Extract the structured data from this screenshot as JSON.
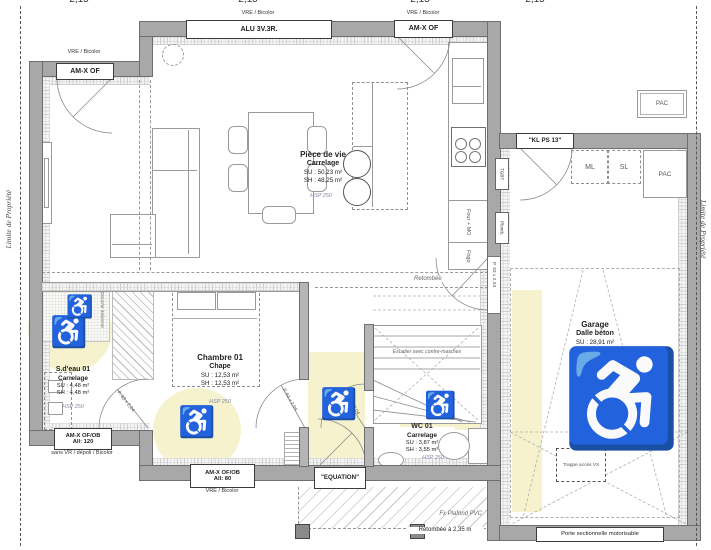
{
  "dimensions": {
    "top": [
      "2,15",
      "2,15",
      "2,15",
      "2,15"
    ]
  },
  "property": {
    "left": "Limite de Propriété",
    "right": "Limite de Propriété"
  },
  "windows": {
    "top_left": {
      "note": "VRE / Bicolor",
      "label": "AM-X OF"
    },
    "top_main": {
      "note": "VRE / Bicolor",
      "label": "ALU 3V.3R."
    },
    "top_right": {
      "note": "VRE / Bicolor",
      "label": "AM-X OF"
    },
    "bathroom": {
      "label": "AM-X OF/OB",
      "sill": "All: 120",
      "note": "sans VR / dépoli / Bicolor"
    },
    "bedroom": {
      "label": "AM-X OF/OB",
      "sill": "All: 80",
      "note": "VRE / Bicolor"
    }
  },
  "doors": {
    "entry": "\"EQUATION\"",
    "garage_side": "\"KL PS 13\"",
    "garage_main": "Porte sectionnelle motorisable",
    "bedroom": "P. 63 x 2,04",
    "bathroom": "P. 63 x 2,04",
    "wc": "P. 63 x 2,04",
    "garage_access": "P. 83 x 2,04"
  },
  "rooms": {
    "living": {
      "name": "Pièce de vie",
      "floor": "Carrelage",
      "su": "SU : 50,23 m²",
      "sh": "SH : 48,25 m²",
      "hsp": "HSP 250"
    },
    "bedroom": {
      "name": "Chambre 01",
      "floor": "Chape",
      "su": "SU : 12,53 m²",
      "sh": "SH : 12,53 m²",
      "hsp": "HSP 250"
    },
    "bathroom": {
      "name": "S.d'eau 01",
      "floor": "Carrelage",
      "su": "SU : 4,48 m²",
      "sh": "SH : 4,48 m²",
      "hsp": "HSP 250"
    },
    "wc": {
      "name": "WC 01",
      "floor": "Carrelage",
      "su": "SU : 3,87 m²",
      "sh": "SH : 3,55 m²",
      "hsp": "HSP 250"
    },
    "garage": {
      "name": "Garage",
      "floor": "Dalle béton",
      "su": "SU : 28,91 m²",
      "frame": "Charpente industrielle"
    }
  },
  "kitchen": {
    "oven": "Four + MO",
    "fridge": "Frigo"
  },
  "garage_items": {
    "ml": "ML",
    "sl": "SL",
    "pac": "PAC",
    "pac_ext": "PAC",
    "hatch": "Trappe accès VS"
  },
  "technical": {
    "tgbt": "TGBT",
    "plumb": "Plomb.",
    "beam": "Retombée",
    "stairs": "Escalier avec contre-marches",
    "shower": "Douche italienne",
    "porch_ceiling": "Fx Plafond PVC",
    "porch_beam": "Retombée à 2,35 m"
  },
  "icons": {
    "wheelchair": "♿"
  },
  "colors": {
    "wall": "#a8a8a8",
    "accessible_zone": "#f6f2cd"
  }
}
